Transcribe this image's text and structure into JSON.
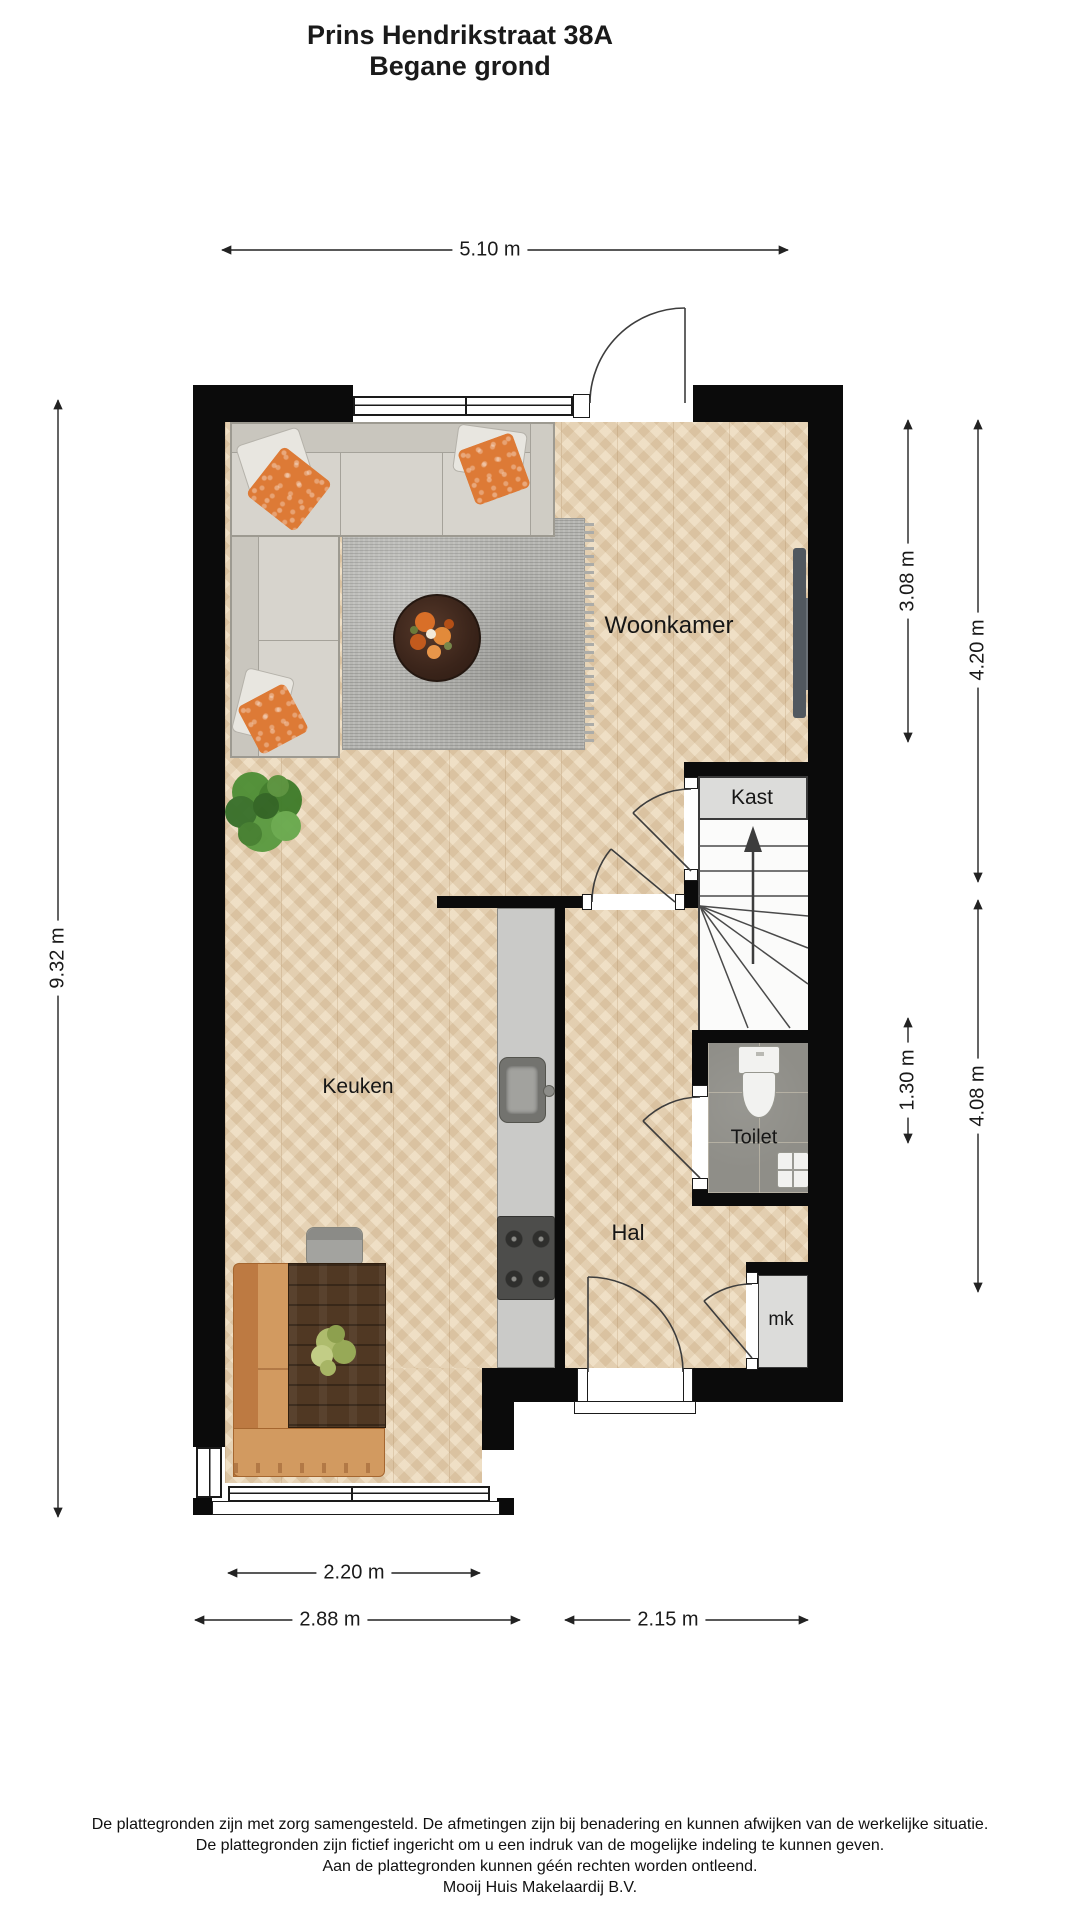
{
  "title": {
    "line1": "Prins Hendrikstraat 38A",
    "line2": "Begane grond"
  },
  "rooms": {
    "woonkamer": "Woonkamer",
    "keuken": "Keuken",
    "hal": "Hal",
    "toilet": "Toilet",
    "kast": "Kast",
    "mk": "mk"
  },
  "dimensions": {
    "top_width": "5.10 m",
    "left_height": "9.32 m",
    "right_upper_inner": "3.08 m",
    "right_upper_outer": "4.20 m",
    "right_lower_inner": "1.30 m",
    "right_lower_outer": "4.08 m",
    "bottom_window_width": "2.20 m",
    "bottom_left_width": "2.88 m",
    "bottom_right_width": "2.15 m"
  },
  "disclaimer": {
    "line1": "De plattegronden zijn met zorg samengesteld. De afmetingen zijn bij benadering en kunnen afwijken van de werkelijke situatie.",
    "line2": "De plattegronden zijn fictief ingericht om u een indruk van de mogelijke indeling te kunnen geven.",
    "line3": "Aan de plattegronden kunnen géén rechten worden ontleend.",
    "line4": "Mooij Huis Makelaardij B.V."
  },
  "colors": {
    "wall": "#0b0b0b",
    "wood_floor": "#ebd9bc",
    "toilet_tile": "#8f8e88",
    "accent_orange": "#dd7a36"
  }
}
